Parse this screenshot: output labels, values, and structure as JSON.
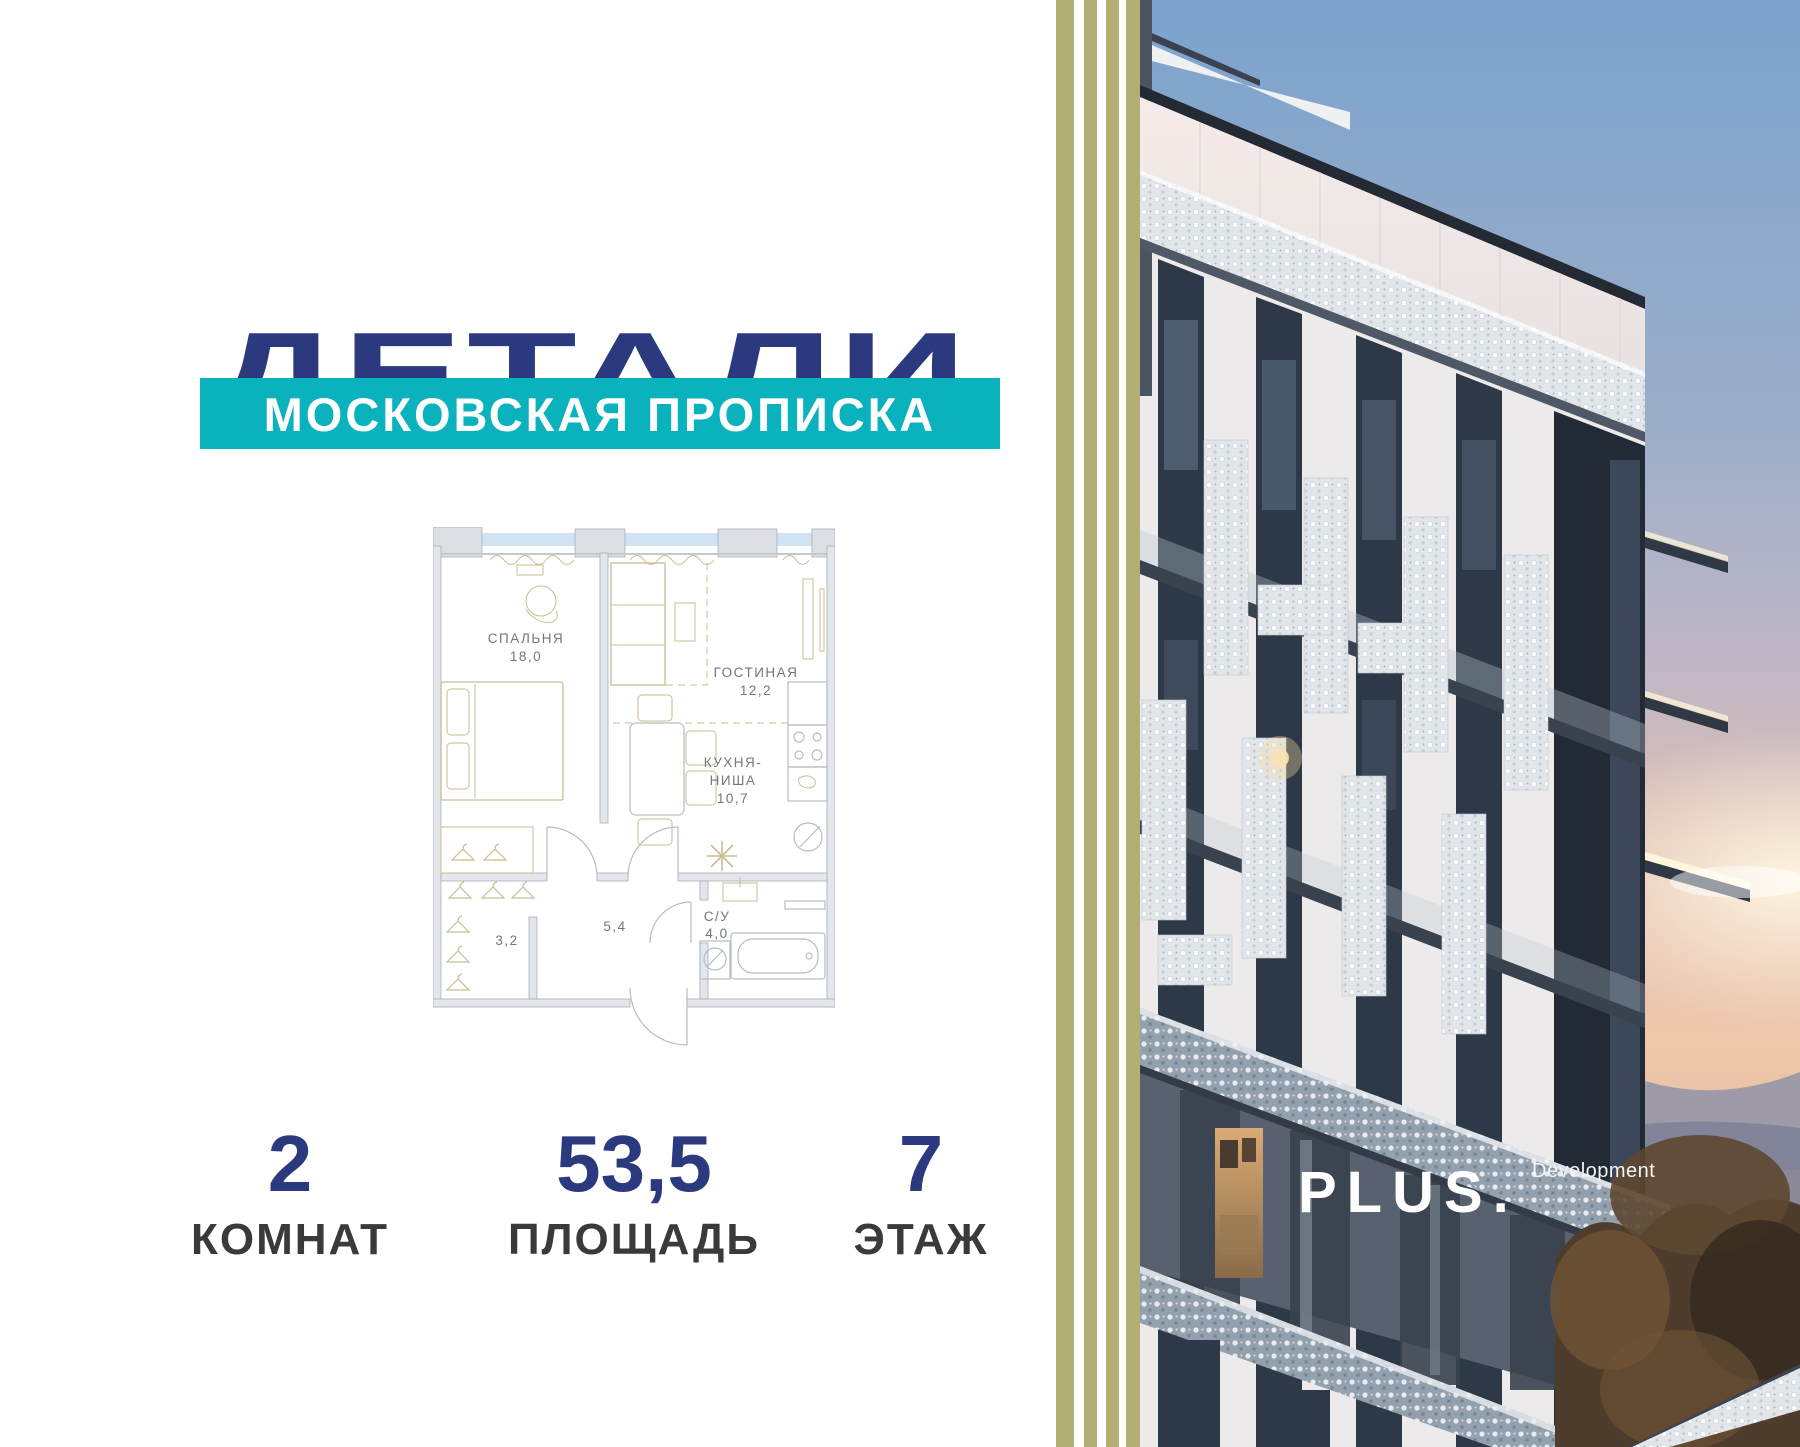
{
  "brand": {
    "title": "ДЕТАЛИ",
    "subtitle": "МОСКОВСКАЯ ПРОПИСКА"
  },
  "floorplan": {
    "bedroom": {
      "name": "СПАЛЬНЯ",
      "area": "18,0"
    },
    "living": {
      "name": "ГОСТИНАЯ",
      "area": "12,2"
    },
    "kitchen": {
      "line1": "КУХНЯ-",
      "line2": "НИША",
      "area": "10,7"
    },
    "bathroom": {
      "name": "С/У",
      "area": "4,0"
    },
    "hallway": {
      "area": "5,4"
    },
    "wardrobe": {
      "area": "3,2"
    }
  },
  "stats": [
    {
      "value": "2",
      "label": "КОМНАТ"
    },
    {
      "value": "53,5",
      "label": "ПЛОЩАДЬ"
    },
    {
      "value": "7",
      "label": "ЭТАЖ"
    }
  ],
  "developer": {
    "logo": "PLUS.",
    "suffix": "Development"
  },
  "colors": {
    "navy": "#2b3a7e",
    "teal": "#09b2bd",
    "stripe_olive": "#b2af74",
    "plan_furniture_tan": "#c9bd92",
    "stat_label_gray": "#3a3a3c"
  }
}
